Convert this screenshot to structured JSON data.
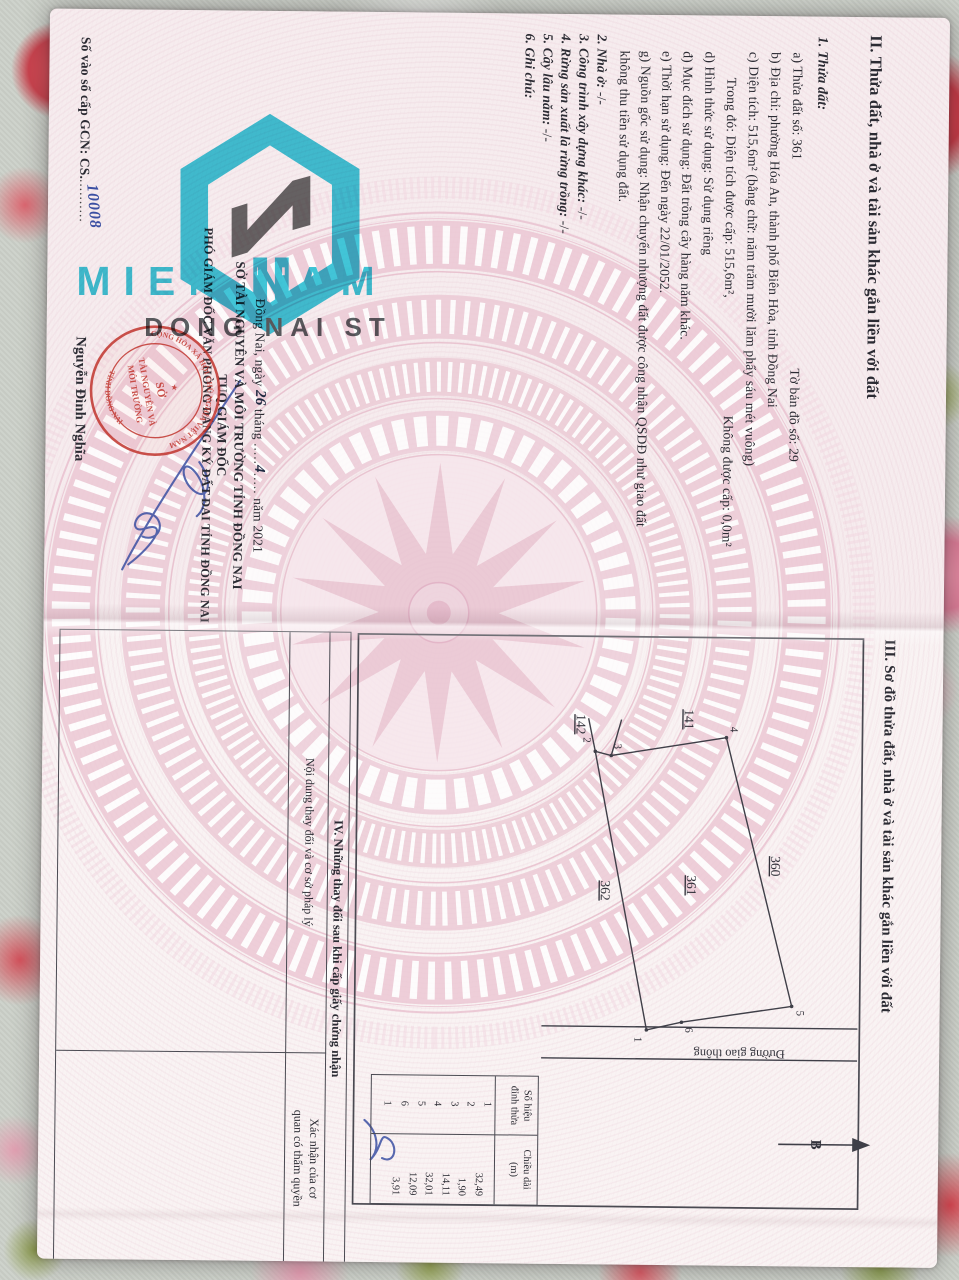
{
  "watermark": {
    "title": "MIEN NAM",
    "subtitle": "DONG NAI ST",
    "teal": "#2fc2d6",
    "gray": "#4d5357"
  },
  "page2": {
    "section_title": "II. Thửa đất, nhà ở và tài sản khác gắn liền với đất",
    "item1_label": "1. Thửa đất:",
    "a_left": "a) Thửa đất số: 361",
    "a_right": "Tờ bản đồ số:  29",
    "b": "b) Địa chỉ: phường Hóa An, thành phố Biên Hòa, tỉnh Đồng Nai",
    "c": "c) Diện tích: 515,6m² (bằng chữ: năm trăm mười lăm phẩy sáu mét vuông)",
    "c2_left": "Trong đó: Diện tích được cấp: 515,6m²,",
    "c2_right": "Không được cấp: 0,0m²",
    "d": "d) Hình thức sử dụng: Sử dụng riêng",
    "dd": "đ) Mục đích sử dụng: Đất trồng cây hàng năm khác.",
    "e": "e) Thời hạn sử dụng: Đến ngày 22/01/2052.",
    "g1": "g) Nguồn gốc sử dụng: Nhận chuyển nhượng đất được công nhận QSDĐ như giao đất",
    "g2": "không thu tiền sử dụng đất.",
    "item2_label": "2. Nhà ở:",
    "item2_value": "-/-",
    "item3_label": "3. Công trình xây dựng khác:",
    "item3_value": "-/-",
    "item4_label": "4. Rừng sản xuất là rừng trồng:",
    "item4_value": "-/-",
    "item5_label": "5. Cây lâu năm:",
    "item5_value": "-/-",
    "item6_label": "6. Ghi chú:",
    "date": {
      "prefix": "Đồng Nai, ngày",
      "day": "26",
      "thang": "tháng",
      "month": "4",
      "nam": "năm 2021",
      "dots": "....."
    },
    "authority": "SỞ TÀI NGUYÊN VÀ MÔI TRƯỜNG TỈNH ĐỒNG NAI",
    "signer_title1": "TUQ.GIÁM ĐỐC",
    "signer_title2": "PHÓ GIÁM ĐỐC VĂN PHÒNG ĐĂNG KÝ ĐẤT ĐAI TỈNH ĐỒNG NAI",
    "signer_name": "Nguyễn Đình Nghĩa",
    "book_no_label": "Số vào sổ cấp GCN: CS.",
    "book_no_dots": "..........",
    "book_no_value": "10008",
    "stamp": {
      "arc_top": "CỘNG HÒA XÃ HỘI CHỦ NGHĨA VIỆT NAM",
      "arc_bottom": "TỈNH ĐỒNG NAI",
      "star": "★",
      "line1": "SỞ",
      "line2": "TÀI NGUYÊN VÀ",
      "line3": "MÔI TRƯỜNG",
      "red": "#c23a33"
    }
  },
  "page3": {
    "section_title": "III. Sơ đồ thửa đất, nhà ở và tài sản khác gắn liền với đất",
    "diagram": {
      "plot_141": "141",
      "plot_142": "142",
      "plot_360": "360",
      "plot_361": "361",
      "plot_362": "362",
      "v1": "1",
      "v2": "2",
      "v3": "3",
      "v4": "4",
      "v5": "5",
      "v6": "6",
      "road_label": "Đường giao thông",
      "north_label": "B"
    },
    "vertex_table": {
      "col1_header_l1": "Số hiệu",
      "col1_header_l2": "đỉnh thửa",
      "col2_header_l1": "Chiều dài",
      "col2_header_l2": "(m)",
      "vertex_ids": [
        "1",
        "2",
        "3",
        "4",
        "5",
        "6",
        "1"
      ],
      "lengths": [
        "32,49",
        "1,90",
        "14,11",
        "32,01",
        "12,09",
        "3,91"
      ]
    },
    "section4_title": "IV. Những thay đổi sau khi cấp giấy chứng nhận",
    "col_content_header": "Nội dung thay đổi và cơ sở pháp lý",
    "col_confirm_l1": "Xác nhận của cơ",
    "col_confirm_l2": "quan có thẩm quyền"
  },
  "colors": {
    "signature_blue": "#3b4fa2",
    "drum_pink": "#e9c2d0",
    "doc_bg": "#f8f0f1"
  }
}
